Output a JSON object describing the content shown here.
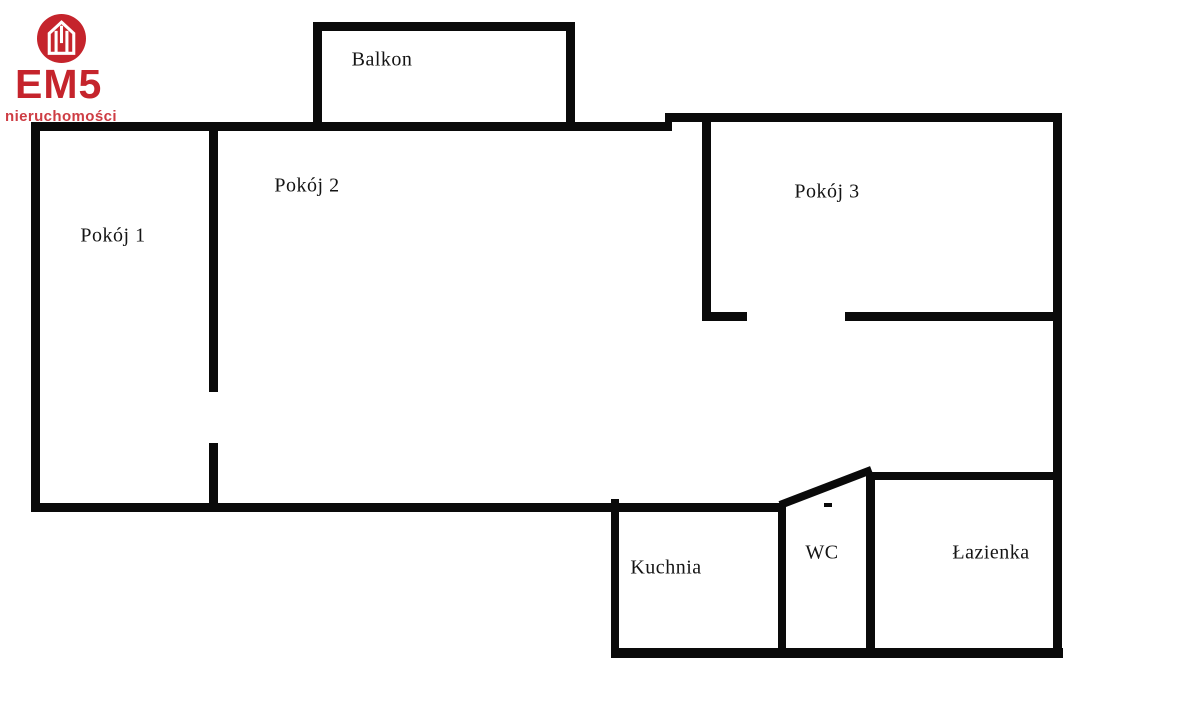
{
  "logo": {
    "brand": "EM5",
    "subtitle": "nieruchomości",
    "accent_color": "#c5242c",
    "icon": "house-icon"
  },
  "floorplan": {
    "wall_color": "#0a0a0a",
    "background_color": "#ffffff",
    "rooms": [
      {
        "id": "balkon",
        "label": "Balkon",
        "cx": 382,
        "cy": 60
      },
      {
        "id": "pokoj-1",
        "label": "Pokój 1",
        "cx": 113,
        "cy": 236
      },
      {
        "id": "pokoj-2",
        "label": "Pokój 2",
        "cx": 307,
        "cy": 186
      },
      {
        "id": "pokoj-3",
        "label": "Pokój 3",
        "cx": 827,
        "cy": 192
      },
      {
        "id": "kuchnia",
        "label": "Kuchnia",
        "cx": 666,
        "cy": 568
      },
      {
        "id": "wc",
        "label": "WC",
        "cx": 822,
        "cy": 553
      },
      {
        "id": "lazienka",
        "label": "Łazienka",
        "cx": 991,
        "cy": 553
      }
    ]
  }
}
